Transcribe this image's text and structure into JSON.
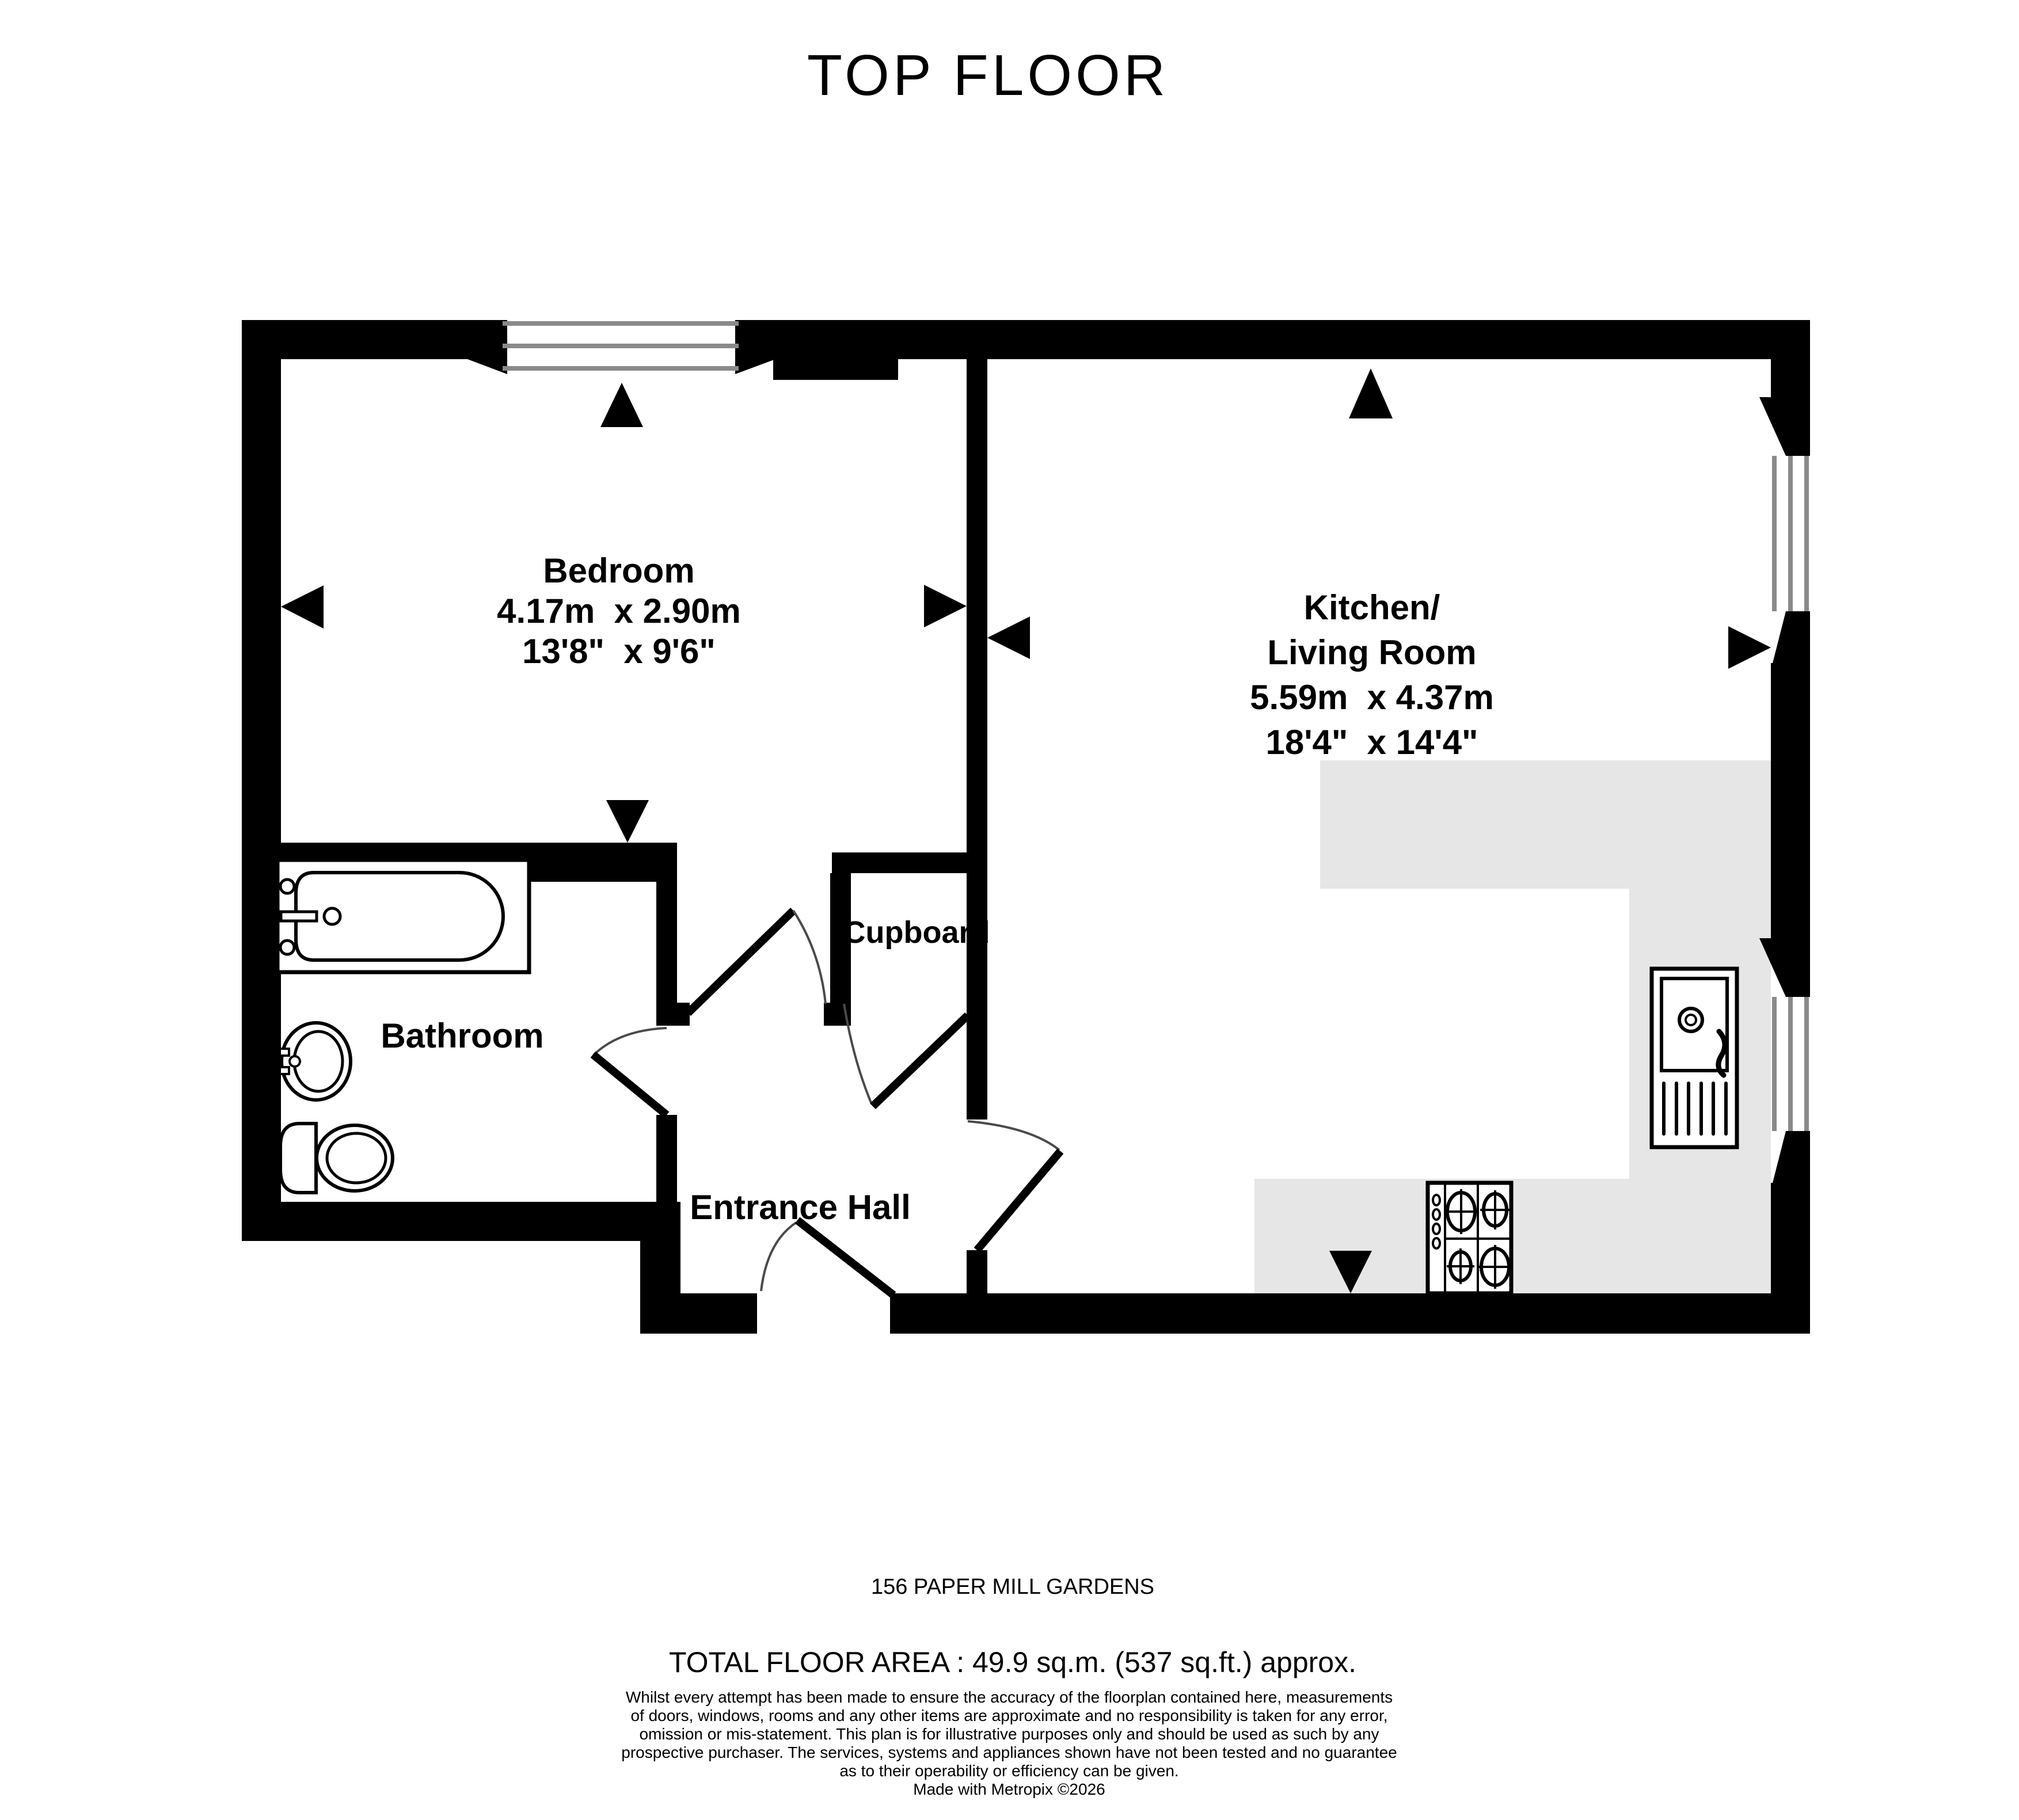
{
  "title": "TOP FLOOR",
  "colors": {
    "wall": "#000000",
    "counter": "#e6e6e6",
    "glazing": "#8a8a8a",
    "background": "#ffffff"
  },
  "rooms": {
    "bedroom": {
      "name": "Bedroom",
      "metric": "4.17m  x 2.90m",
      "imperial": "13'8\"  x 9'6\""
    },
    "kitchen_living": {
      "name_line1": "Kitchen/",
      "name_line2": "Living Room",
      "metric": "5.59m  x 4.37m",
      "imperial": "18'4\"  x 14'4\""
    },
    "bathroom": {
      "name": "Bathroom"
    },
    "cupboard": {
      "name": "Cupboard"
    },
    "entrance_hall": {
      "name": "Entrance Hall"
    }
  },
  "footer": {
    "address": "156 PAPER MILL GARDENS",
    "total_area": "TOTAL FLOOR AREA : 49.9 sq.m. (537 sq.ft.) approx.",
    "disclaimer_lines": [
      "Whilst every attempt has been made to ensure the accuracy of the floorplan contained here, measurements",
      "of doors, windows, rooms and any other items are approximate and no responsibility is taken for any error,",
      "omission or mis-statement. This plan is for illustrative purposes only and should be used as such by any",
      "prospective purchaser. The services, systems and appliances shown have not been tested and no guarantee",
      "as to their operability or efficiency can be given."
    ],
    "credit": "Made with Metropix ©2026"
  }
}
